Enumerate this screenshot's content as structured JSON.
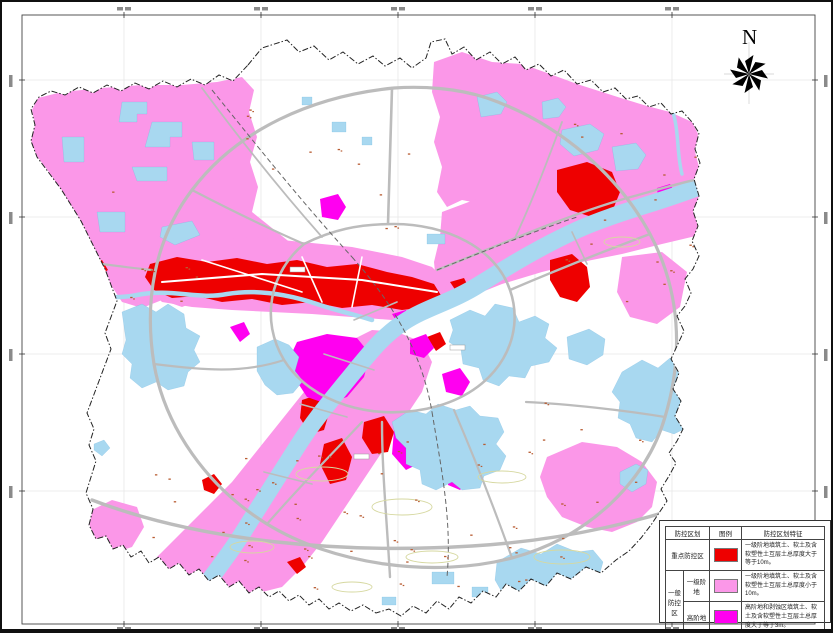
{
  "compass": {
    "label": "N"
  },
  "legend": {
    "headers": {
      "zoning": "防控区划",
      "symbol": "图例",
      "feature": "防控区划特征"
    },
    "rows": [
      {
        "zone": "重点防控区",
        "sub": "",
        "color": "#ee0000",
        "desc": "一级阶地填筑土、软土及含软塑性土互层土总厚度大于等于10m。"
      },
      {
        "zone": "一般防控区",
        "sub": "一级阶地",
        "color": "#fb97e8",
        "desc": "一级阶地填筑土、软土及含软塑性土互层土总厚度小于10m。"
      },
      {
        "zone": "一般防控区",
        "sub": "高阶地",
        "color": "#ff00f0",
        "desc": "高阶地和剥蚀区填筑土、软土及含软塑性土互层土总厚度大于等于3m。"
      }
    ]
  },
  "map_colors": {
    "key_zone_red": "#ee0000",
    "first_terrace_pink": "#fb97e8",
    "high_terrace_magenta": "#ff00f0",
    "water_blue": "#a8d8f0",
    "road_gray": "#bcbcbc",
    "grid_gray": "#e7e7e7",
    "boundary_black": "#222222",
    "village_mark_brown": "#b85c32",
    "contour_olive": "#d6d8a0"
  }
}
